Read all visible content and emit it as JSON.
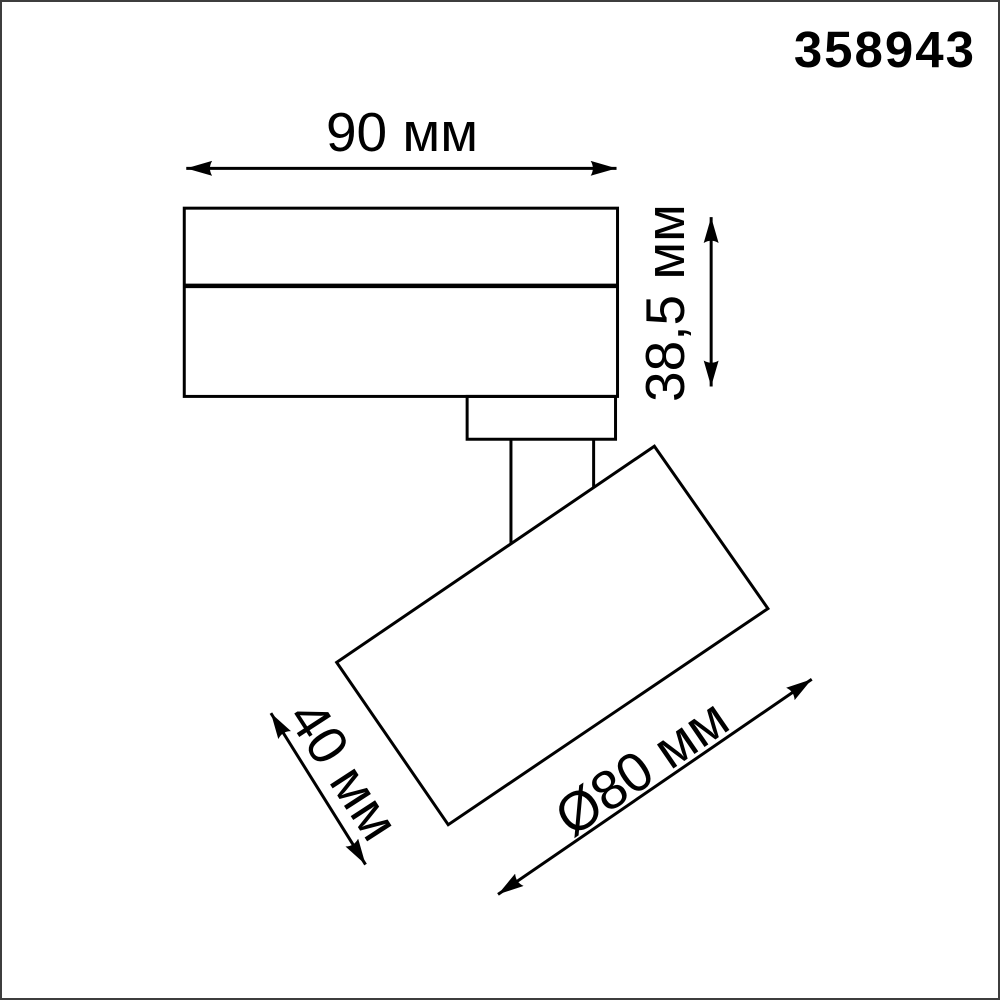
{
  "product": {
    "code": "358943"
  },
  "drawing": {
    "labels": {
      "body_width": "90 мм",
      "body_height": "38,5 мм",
      "head_length": "40 мм",
      "head_diameter": "Ø80 мм"
    }
  },
  "colors": {
    "line": "#000000",
    "background": "#ffffff",
    "frame": "#3d3d3d"
  }
}
